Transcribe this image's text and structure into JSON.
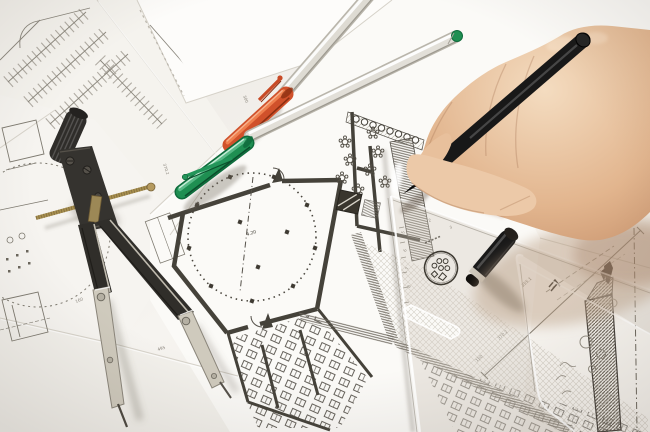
{
  "scene": {
    "dimension_labels": [
      "370.2",
      "495",
      "300",
      "160",
      "255.1",
      "150"
    ],
    "room_label": "4.20",
    "ruler": {
      "scale_numbers": [
        "2",
        "3",
        "5",
        "6",
        "7",
        "8"
      ]
    }
  },
  "colors": {
    "paper": "#f7f5f1",
    "paper_bright": "#fdfcfa",
    "paper_shadow": "#e6e2db",
    "plan_ink": "#45423a",
    "pencil": "#8a857c",
    "orange_cap": "#d0512b",
    "green_cap": "#1f8f52",
    "pen_barrel": "#dedbd3",
    "black_pen": "#181818",
    "compass_body": "#34322e",
    "compass_steel": "#cfcabd",
    "brass": "#a8904f",
    "skin": "#ecc9a8",
    "skin_shadow": "#c2906c",
    "ruler_tint": "rgba(205,195,182,0.32)",
    "section_hatch": "#57524a"
  }
}
